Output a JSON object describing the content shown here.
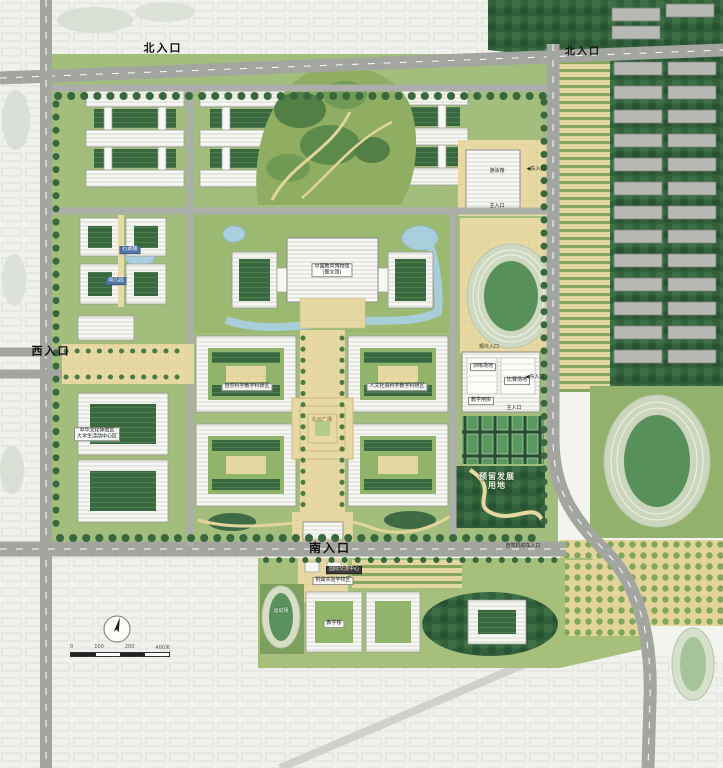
{
  "entrances": {
    "north_west": "北入口",
    "north_east": "北入口",
    "west": "西入口",
    "south": "南入口",
    "east_pool": "◀东入口",
    "east_gym": "◀东入口",
    "stadium_main": "主入口",
    "gym_main": "主入口",
    "gym_spectator": "观众入口",
    "vehicle": "自驾机动车入口"
  },
  "buildings": {
    "swim_hall": "游泳馆",
    "library_line1": "中国教育博物馆",
    "library_line2": "(图文馆)",
    "admin": "行政楼",
    "kindergarten": "幼儿园",
    "gym_training": "训练场地",
    "gym_competition": "比赛场地",
    "gym_classrooms": "教学用房",
    "school_building": "教学楼",
    "intl_center": "国际交流中心"
  },
  "zones": {
    "humanities": "人文社会科学教学科研区",
    "sciences": "自然科学教学科研区",
    "ceremony_plaza": "礼仪广场",
    "reserved_line1": "预留发展",
    "reserved_line2": "用地",
    "culture_line1": "中华文化体验区",
    "culture_line2": "大学生活动中心区",
    "attached_school": "附属实验学校区",
    "sports_field": "运动场"
  },
  "legend": {
    "scale_ticks": [
      "0",
      "100",
      "200",
      "400米"
    ]
  },
  "colors": {
    "road": "#a2a5a0",
    "campus_green": "#a3be7c",
    "forest": "#31603a",
    "plaza": "#e7d9a4",
    "water": "#a9cfde",
    "building": "#f7f7f3",
    "track_infield": "#579058"
  }
}
